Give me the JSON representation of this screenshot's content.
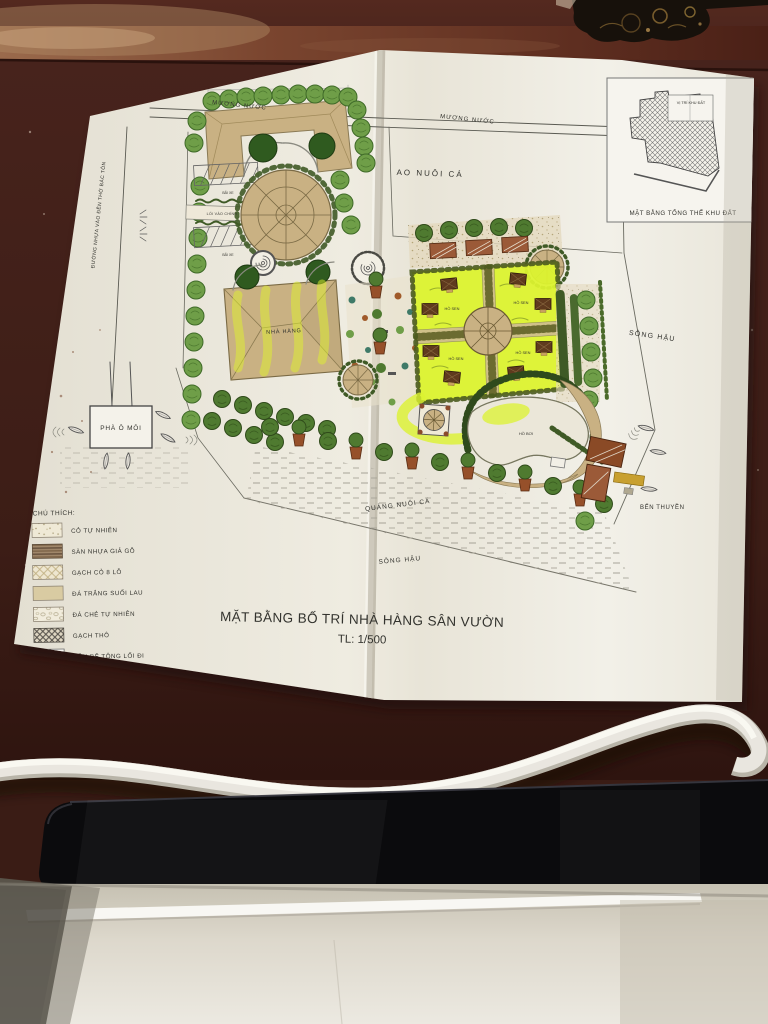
{
  "photo": {
    "description": "printed landscape site plan on dark wooden desk, white cable and black laptop edge in foreground",
    "palette": {
      "desk_wood": "#47231c",
      "paper": "#f0ede3",
      "highlight_marker": "#dcf32f",
      "roof_tan": "#c9b183",
      "roof_red": "#9b5a38",
      "tree_green": "#6f9e48",
      "hedge_dark": "#3f5a26",
      "cable_white": "#e9e6df",
      "laptop_black": "#0b0b0d",
      "surface_beige": "#ddd8cc"
    },
    "symbols": [
      "tree-icon",
      "potted-plant-icon",
      "boat-icon",
      "hut-icon",
      "gazebo-icon",
      "car-icon"
    ]
  },
  "plan": {
    "title": "MẶT BẰNG BỐ TRÍ NHÀ HÀNG SÂN VƯỜN",
    "scale": "TL: 1/500",
    "inset": {
      "site_label": "VỊ TRÍ KHU ĐẤT",
      "caption": "MẶT BẰNG TỔNG THỂ KHU ĐẤT"
    },
    "labels": {
      "channel": "MƯƠNG NƯỚC",
      "fish_pond": "AO NUÔI CÁ",
      "road": "ĐƯỜNG NHỰA VÀO ĐỀN THỜ BÁC TÔN",
      "river": "SÔNG HẬU",
      "fish_corral": "QUẢNG NUÔI CÁ",
      "boat_dock": "BẾN THUYỀN",
      "ferry": "PHÀ Ô MÔI",
      "main_entrance": "LỐI VÀO CHÍNH",
      "parking": "BÃI XE",
      "restaurant": "NHÀ HÀNG",
      "lotus_pond": "HỒ SEN",
      "pool": "HỒ BƠI"
    },
    "legend": {
      "heading": "CHÚ THÍCH:",
      "items": [
        {
          "label": "CỎ TỰ NHIÊN",
          "pattern": "grass-dots"
        },
        {
          "label": "SÀN NHỰA GIẢ GỖ",
          "pattern": "wood-stripes"
        },
        {
          "label": "GẠCH CỎ 8 LỖ",
          "pattern": "light-crosshatch"
        },
        {
          "label": "ĐÁ TRẮNG SUỐI LAU",
          "pattern": "plain-tan"
        },
        {
          "label": "ĐÁ CHẺ TỰ NHIÊN",
          "pattern": "pebble"
        },
        {
          "label": "GẠCH THÔ",
          "pattern": "dark-crosshatch"
        },
        {
          "label": "NỀN BÊ TÔNG LỐI ĐI",
          "pattern": "plain-white"
        }
      ]
    }
  }
}
